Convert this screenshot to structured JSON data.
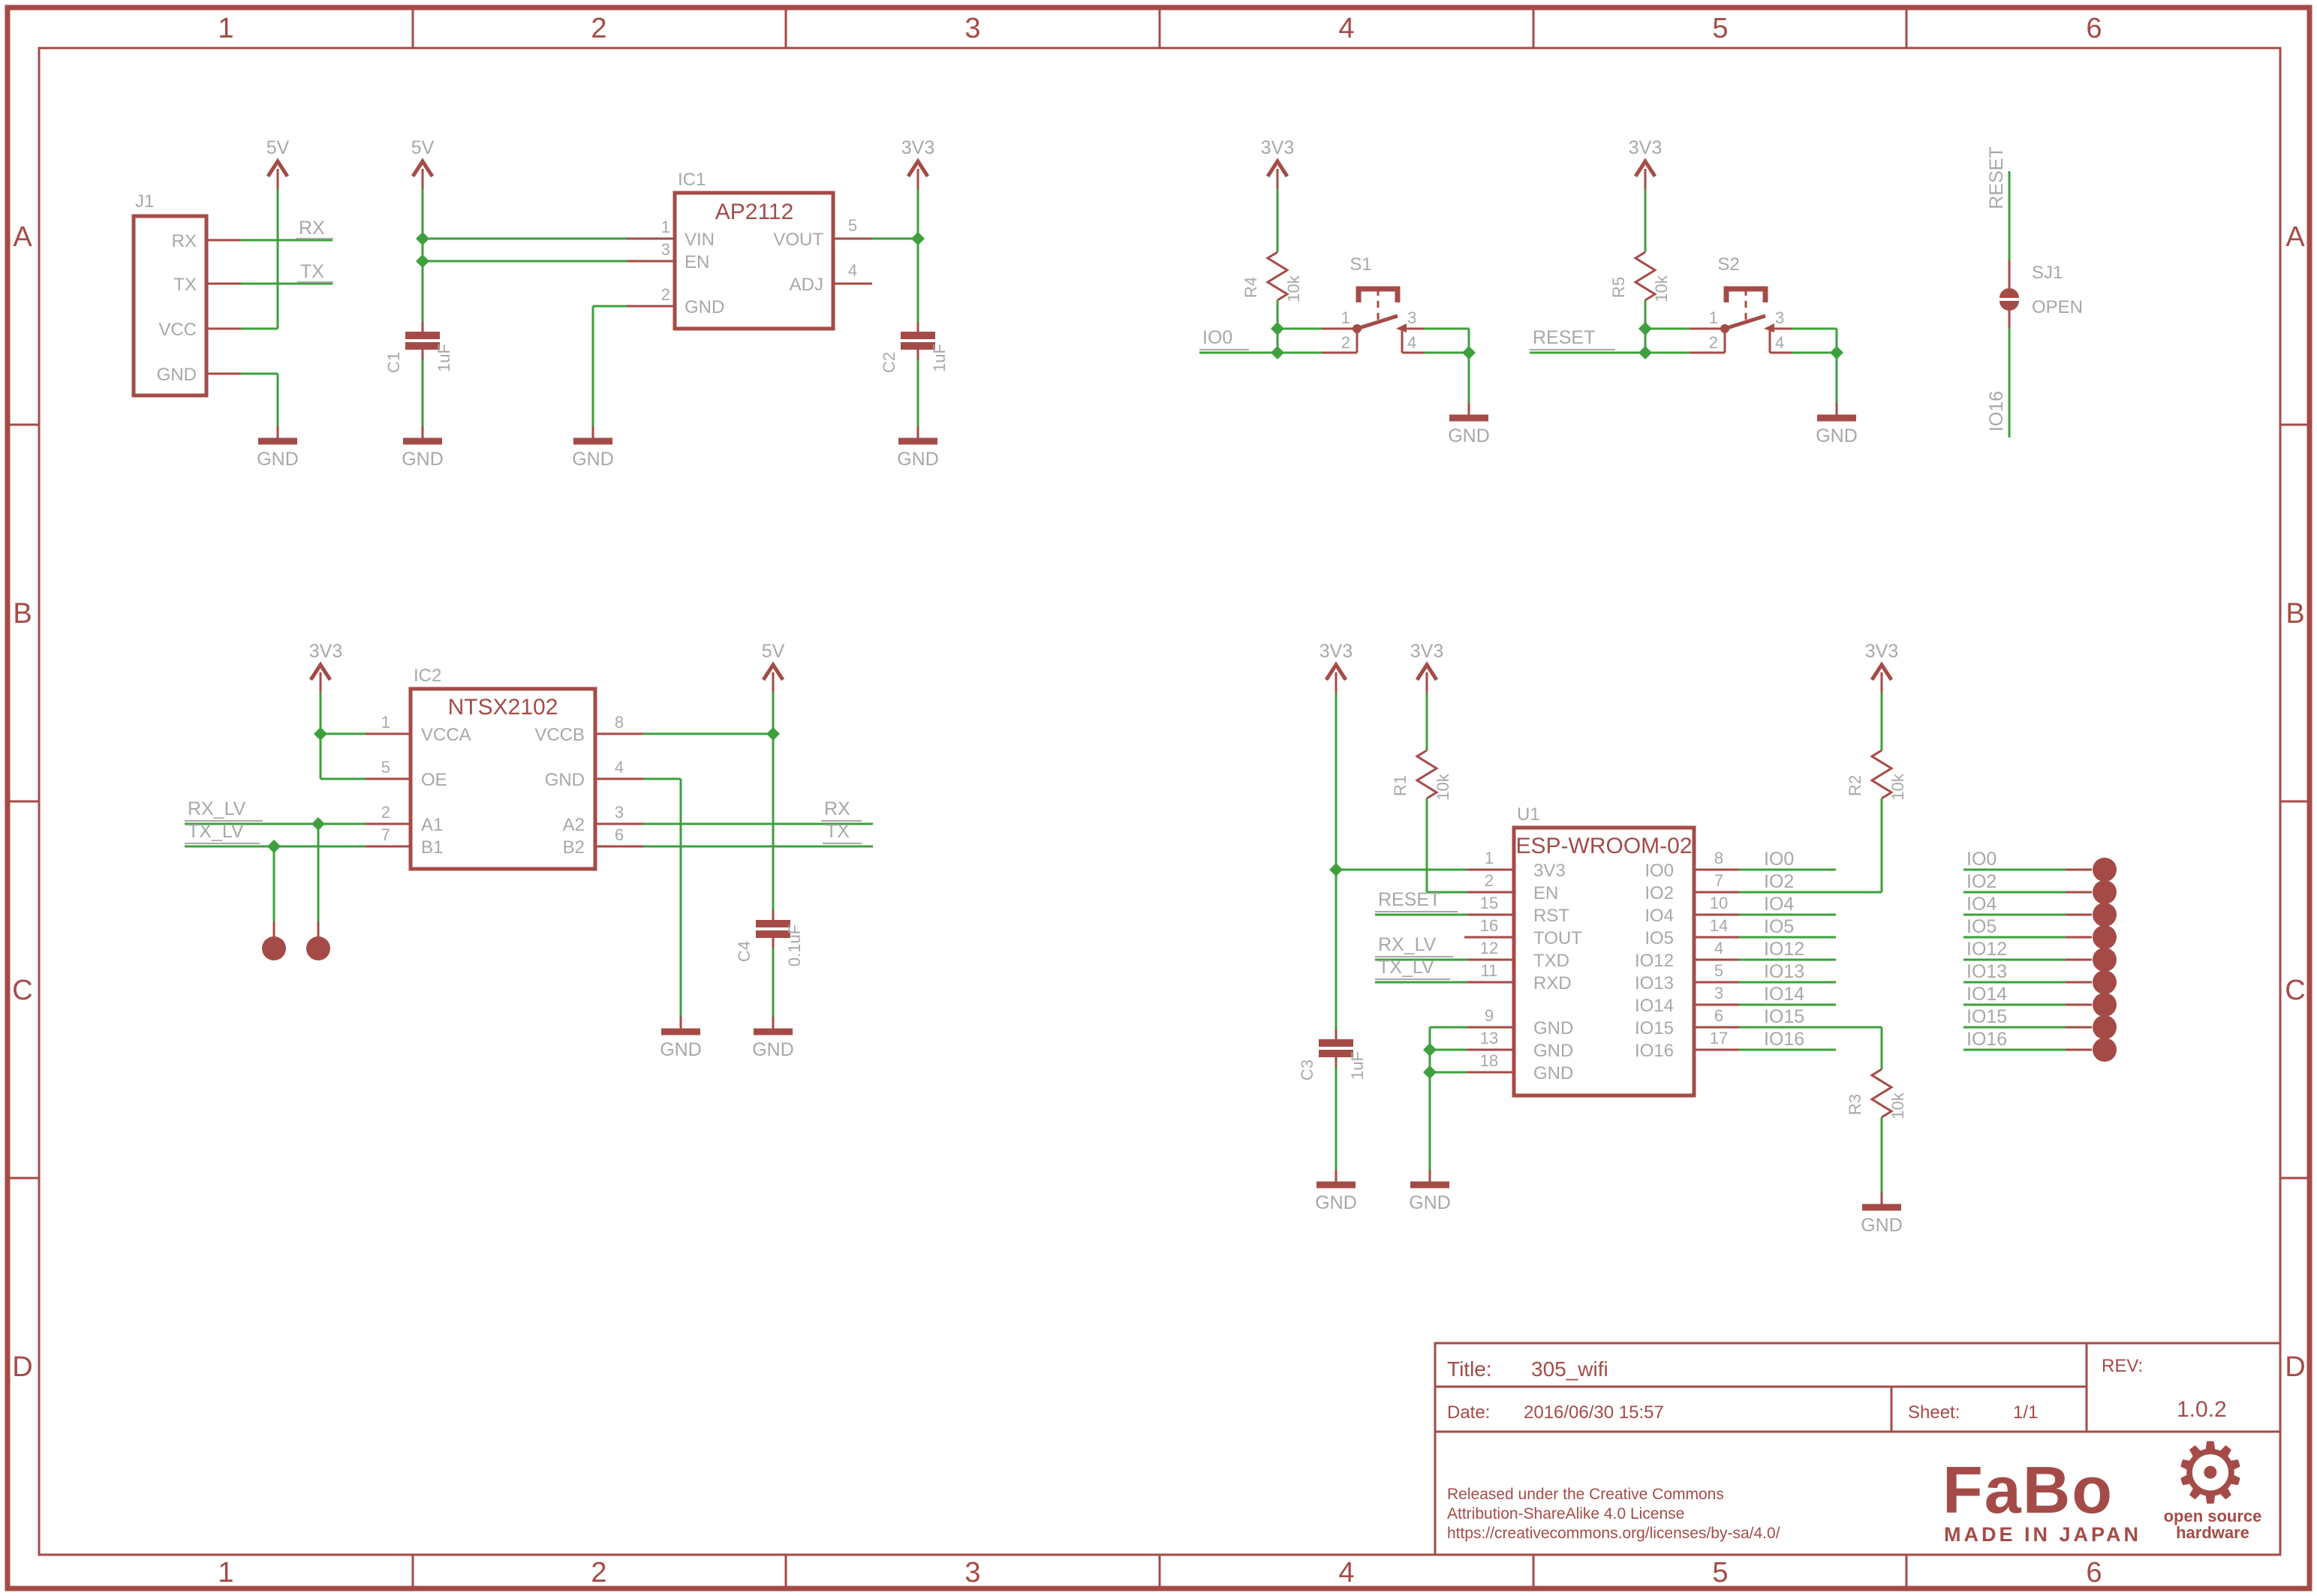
{
  "colors": {
    "symbol": "#a54b47",
    "wire": "#3da03c",
    "label_gray": "#a8a8a8"
  },
  "frame": {
    "columns": [
      "1",
      "2",
      "3",
      "4",
      "5",
      "6"
    ],
    "rows": [
      "A",
      "B",
      "C",
      "D"
    ]
  },
  "title_block": {
    "title_label": "Title:",
    "title_value": "305_wifi",
    "date_label": "Date:",
    "date_value": "2016/06/30 15:57",
    "sheet_label": "Sheet:",
    "sheet_value": "1/1",
    "rev_label": "REV:",
    "rev_value": "1.0.2",
    "license": [
      "Released under the Creative Commons",
      "Attribution-ShareAlike 4.0 License",
      "https://creativecommons.org/licenses/by-sa/4.0/"
    ],
    "logo_text": "FaBo",
    "made_in": "MADE IN JAPAN",
    "oshw": [
      "open source",
      "hardware"
    ],
    "oshw_gear": "⚙"
  },
  "nets": {
    "v5": "5V",
    "v33": "3V3",
    "gnd": "GND",
    "rx": "RX",
    "tx": "TX",
    "rx_lv": "RX_LV",
    "tx_lv": "TX_LV",
    "io0": "IO0",
    "reset": "RESET",
    "io16": "IO16"
  },
  "parts": {
    "j1": {
      "ref": "J1",
      "pins": [
        "RX",
        "TX",
        "VCC",
        "GND"
      ]
    },
    "ic1": {
      "ref": "IC1",
      "value": "AP2112",
      "pins": [
        {
          "num": "1",
          "name": "VIN"
        },
        {
          "num": "3",
          "name": "EN"
        },
        {
          "num": "2",
          "name": "GND"
        },
        {
          "num": "5",
          "name": "VOUT"
        },
        {
          "num": "4",
          "name": "ADJ"
        }
      ]
    },
    "ic2": {
      "ref": "IC2",
      "value": "NTSX2102",
      "pins": [
        {
          "num": "1",
          "name": "VCCA"
        },
        {
          "num": "5",
          "name": "OE"
        },
        {
          "num": "2",
          "name": "A1"
        },
        {
          "num": "7",
          "name": "B1"
        },
        {
          "num": "8",
          "name": "VCCB"
        },
        {
          "num": "4",
          "name": "GND"
        },
        {
          "num": "3",
          "name": "A2"
        },
        {
          "num": "6",
          "name": "B2"
        }
      ]
    },
    "u1": {
      "ref": "U1",
      "value": "ESP-WROOM-02",
      "left": [
        {
          "num": "1",
          "name": "3V3"
        },
        {
          "num": "2",
          "name": "EN"
        },
        {
          "num": "15",
          "name": "RST"
        },
        {
          "num": "16",
          "name": "TOUT"
        },
        {
          "num": "12",
          "name": "TXD"
        },
        {
          "num": "11",
          "name": "RXD"
        },
        {
          "num": "9",
          "name": "GND"
        },
        {
          "num": "13",
          "name": "GND"
        },
        {
          "num": "18",
          "name": "GND"
        }
      ],
      "right": [
        {
          "num": "8",
          "name": "IO0"
        },
        {
          "num": "7",
          "name": "IO2"
        },
        {
          "num": "10",
          "name": "IO4"
        },
        {
          "num": "14",
          "name": "IO5"
        },
        {
          "num": "4",
          "name": "IO12"
        },
        {
          "num": "5",
          "name": "IO13"
        },
        {
          "num": "3",
          "name": "IO14"
        },
        {
          "num": "6",
          "name": "IO15"
        },
        {
          "num": "17",
          "name": "IO16"
        }
      ]
    },
    "r1": {
      "ref": "R1",
      "value": "10k"
    },
    "r2": {
      "ref": "R2",
      "value": "10k"
    },
    "r3": {
      "ref": "R3",
      "value": "10k"
    },
    "r4": {
      "ref": "R4",
      "value": "10k"
    },
    "r5": {
      "ref": "R5",
      "value": "10k"
    },
    "c1": {
      "ref": "C1",
      "value": "1uF"
    },
    "c2": {
      "ref": "C2",
      "value": "1uF"
    },
    "c3": {
      "ref": "C3",
      "value": "1uF"
    },
    "c4": {
      "ref": "C4",
      "value": "0.1uF"
    },
    "s1": {
      "ref": "S1",
      "pins": [
        "1",
        "2",
        "3",
        "4"
      ]
    },
    "s2": {
      "ref": "S2",
      "pins": [
        "1",
        "2",
        "3",
        "4"
      ]
    },
    "sj1": {
      "ref": "SJ1",
      "value": "OPEN"
    }
  },
  "header": {
    "labels": [
      "IO0",
      "IO2",
      "IO4",
      "IO5",
      "IO12",
      "IO13",
      "IO14",
      "IO15",
      "IO16"
    ]
  }
}
